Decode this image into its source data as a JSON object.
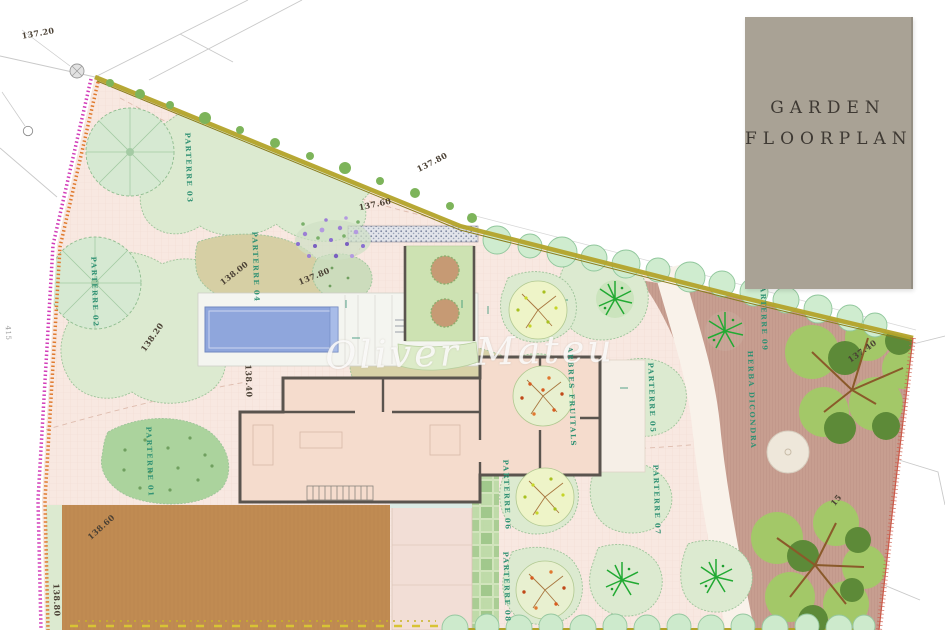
{
  "title_block": {
    "line1": "GARDEN",
    "line2": "FLOORPLAN"
  },
  "watermark": {
    "text": "Oliver Mateu"
  },
  "colors": {
    "ground": "#f8e8e1",
    "terrace_mauve": "#c79e90",
    "terrace_brown": "#c08b52",
    "pool": "#8fa6dc",
    "hedge_top": "#b3a32a",
    "hedge_pink": "#d23db8",
    "hedge_orange": "#e07a2e",
    "boundary_red": "#cc5a4a",
    "parterre_green": "#dcead0",
    "parterre_tan": "#d6cfa4",
    "bush_green": "#abd39d",
    "courtyard": "#cde2b2",
    "house_room": "#f5dccd",
    "wall": "#5a544e",
    "title_bg": "#a9a295",
    "title_text": "#3e3933",
    "label_green": "#2f9173",
    "label_dark": "#4a4034"
  },
  "labels": [
    {
      "text": "PARTERRE 01",
      "x": 150,
      "y": 462,
      "rot": 88,
      "type": "parterre"
    },
    {
      "text": "PARTERRE 02",
      "x": 95,
      "y": 292,
      "rot": 88,
      "type": "parterre"
    },
    {
      "text": "PARTERRE 03",
      "x": 189,
      "y": 168,
      "rot": 88,
      "type": "parterre"
    },
    {
      "text": "PARTERRE 04",
      "x": 256,
      "y": 267,
      "rot": 88,
      "type": "parterre"
    },
    {
      "text": "PARTERRE 05",
      "x": 652,
      "y": 398,
      "rot": 88,
      "type": "parterre"
    },
    {
      "text": "PARTERRE 06",
      "x": 507,
      "y": 495,
      "rot": 88,
      "type": "parterre"
    },
    {
      "text": "PARTERRE 07",
      "x": 657,
      "y": 500,
      "rot": 88,
      "type": "parterre"
    },
    {
      "text": "PARTERRE 08",
      "x": 507,
      "y": 587,
      "rot": 88,
      "type": "parterre"
    },
    {
      "text": "PARTERRE 09",
      "x": 764,
      "y": 316,
      "rot": 88,
      "type": "parterre"
    },
    {
      "text": "ARBRES FRUITALS",
      "x": 572,
      "y": 397,
      "rot": 88,
      "type": "area"
    },
    {
      "text": "HERBA DICONDRA",
      "x": 752,
      "y": 400,
      "rot": 88,
      "type": "area"
    },
    {
      "text": "137.20",
      "x": 38,
      "y": 33,
      "rot": -10,
      "type": "elev"
    },
    {
      "text": "137.80",
      "x": 432,
      "y": 162,
      "rot": -27,
      "type": "elev"
    },
    {
      "text": "137.60",
      "x": 375,
      "y": 204,
      "rot": -12,
      "type": "elev"
    },
    {
      "text": "137.80",
      "x": 314,
      "y": 276,
      "rot": -22,
      "type": "elev"
    },
    {
      "text": "138.00",
      "x": 234,
      "y": 273,
      "rot": -38,
      "type": "elev"
    },
    {
      "text": "138.20",
      "x": 152,
      "y": 337,
      "rot": -55,
      "type": "elev"
    },
    {
      "text": "138.40",
      "x": 249,
      "y": 381,
      "rot": 88,
      "type": "elev"
    },
    {
      "text": "138.60",
      "x": 101,
      "y": 527,
      "rot": -42,
      "type": "elev"
    },
    {
      "text": "138.80",
      "x": 57,
      "y": 600,
      "rot": 88,
      "type": "elev"
    },
    {
      "text": "137.40",
      "x": 862,
      "y": 351,
      "rot": -35,
      "type": "elev"
    },
    {
      "text": "15",
      "x": 836,
      "y": 500,
      "rot": -50,
      "type": "elev"
    },
    {
      "text": "415",
      "x": 8,
      "y": 333,
      "rot": 88,
      "type": "survey"
    }
  ]
}
